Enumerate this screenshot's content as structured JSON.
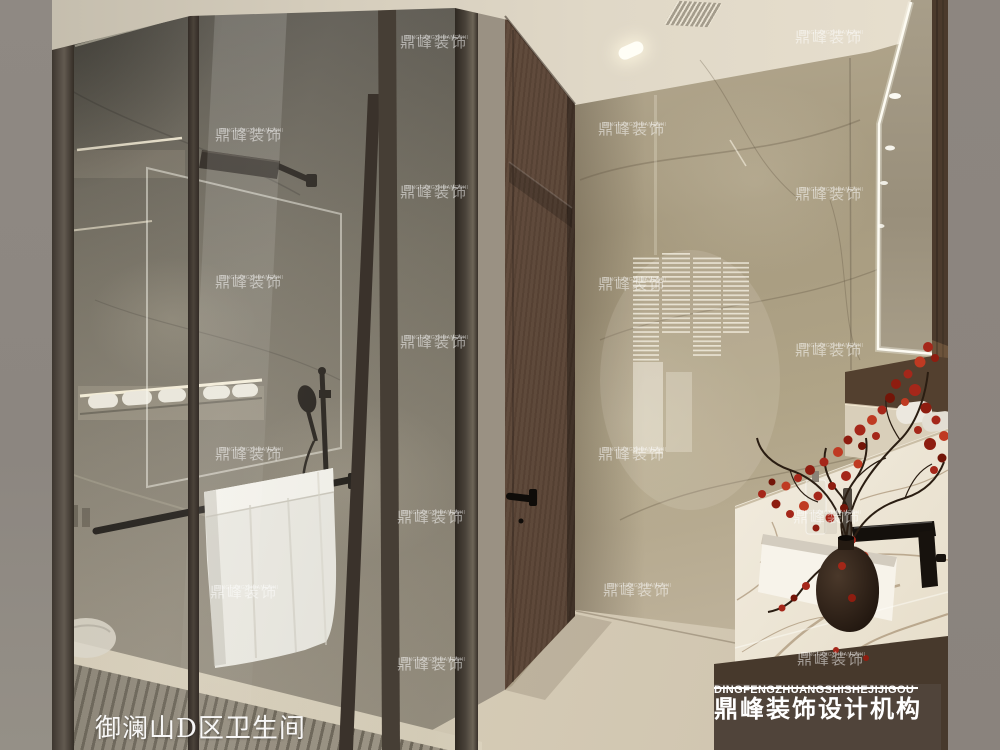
{
  "caption": {
    "text": "御澜山D区卫生间"
  },
  "brand_plate": {
    "title_cn": "鼎峰装饰设计机构",
    "title_en": "DINGFENGZHUANGSHISHEJIJIGOU",
    "bg_color": "#50443a",
    "text_color": "#ffffff"
  },
  "watermark": {
    "text_cn": "鼎峰装饰",
    "text_en": "DINGFENGZHUANGSHI",
    "color": "rgba(255,255,255,0.5)",
    "positions": [
      [
        215,
        128
      ],
      [
        215,
        275
      ],
      [
        215,
        447
      ],
      [
        210,
        585
      ],
      [
        400,
        35
      ],
      [
        400,
        185
      ],
      [
        400,
        335
      ],
      [
        397,
        510
      ],
      [
        397,
        657
      ],
      [
        598,
        122
      ],
      [
        598,
        277
      ],
      [
        598,
        447
      ],
      [
        603,
        583
      ],
      [
        795,
        30
      ],
      [
        795,
        187
      ],
      [
        795,
        343
      ],
      [
        793,
        510
      ],
      [
        797,
        652
      ]
    ]
  },
  "palette": {
    "ceiling": "#ded6c5",
    "wall_marble_light": "#b1a68d",
    "wall_marble_dark": "#6b655a",
    "door_walnut": "#5c4636",
    "floor": "#d8cfba",
    "floor_slats": "#9c9384",
    "glass_frame": "#3f372f",
    "side_strip_left": "#908a84",
    "side_strip_right": "#8b847e",
    "counter_marble": "#efe8da",
    "flowers_red": "#a5271a",
    "vase": "#241a12",
    "towel": "#eae8e1",
    "fixtures_black": "#17120d"
  }
}
